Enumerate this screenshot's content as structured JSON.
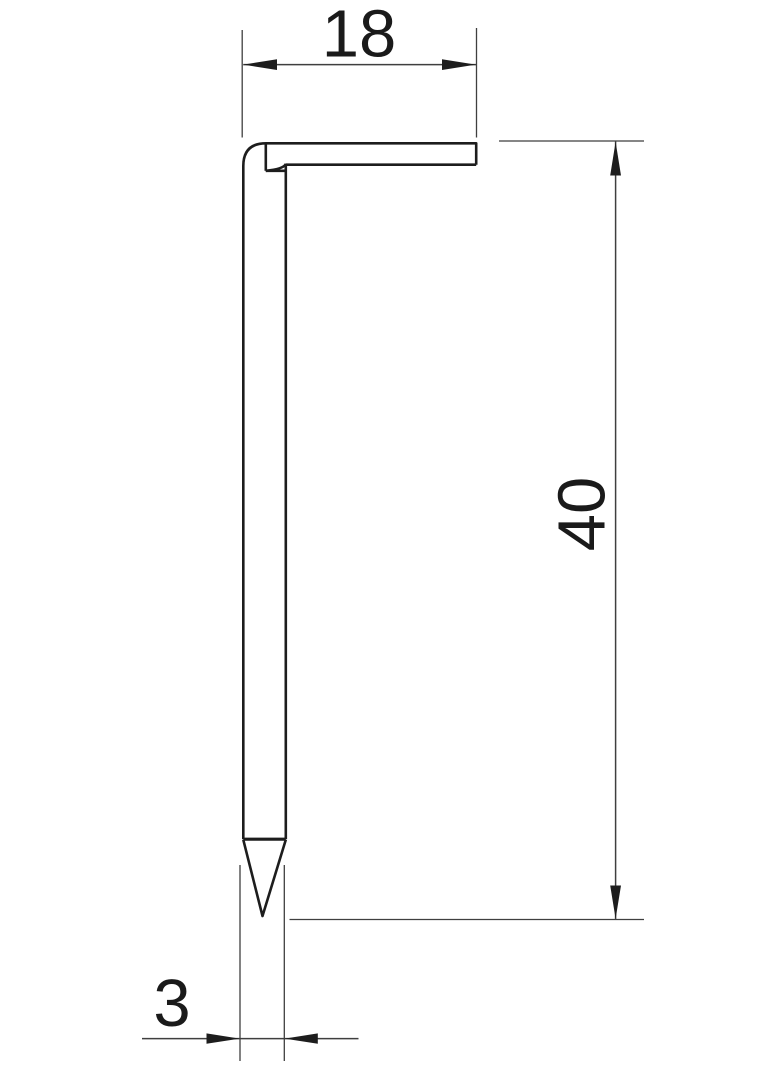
{
  "drawing": {
    "dimensions": {
      "top_width": "18",
      "height": "40",
      "shank_thickness": "3"
    },
    "colors": {
      "outline": "#1d1d1d",
      "dimension_lines": "#3f3f3f",
      "text": "#1a1a1a",
      "background": "#ffffff"
    }
  }
}
